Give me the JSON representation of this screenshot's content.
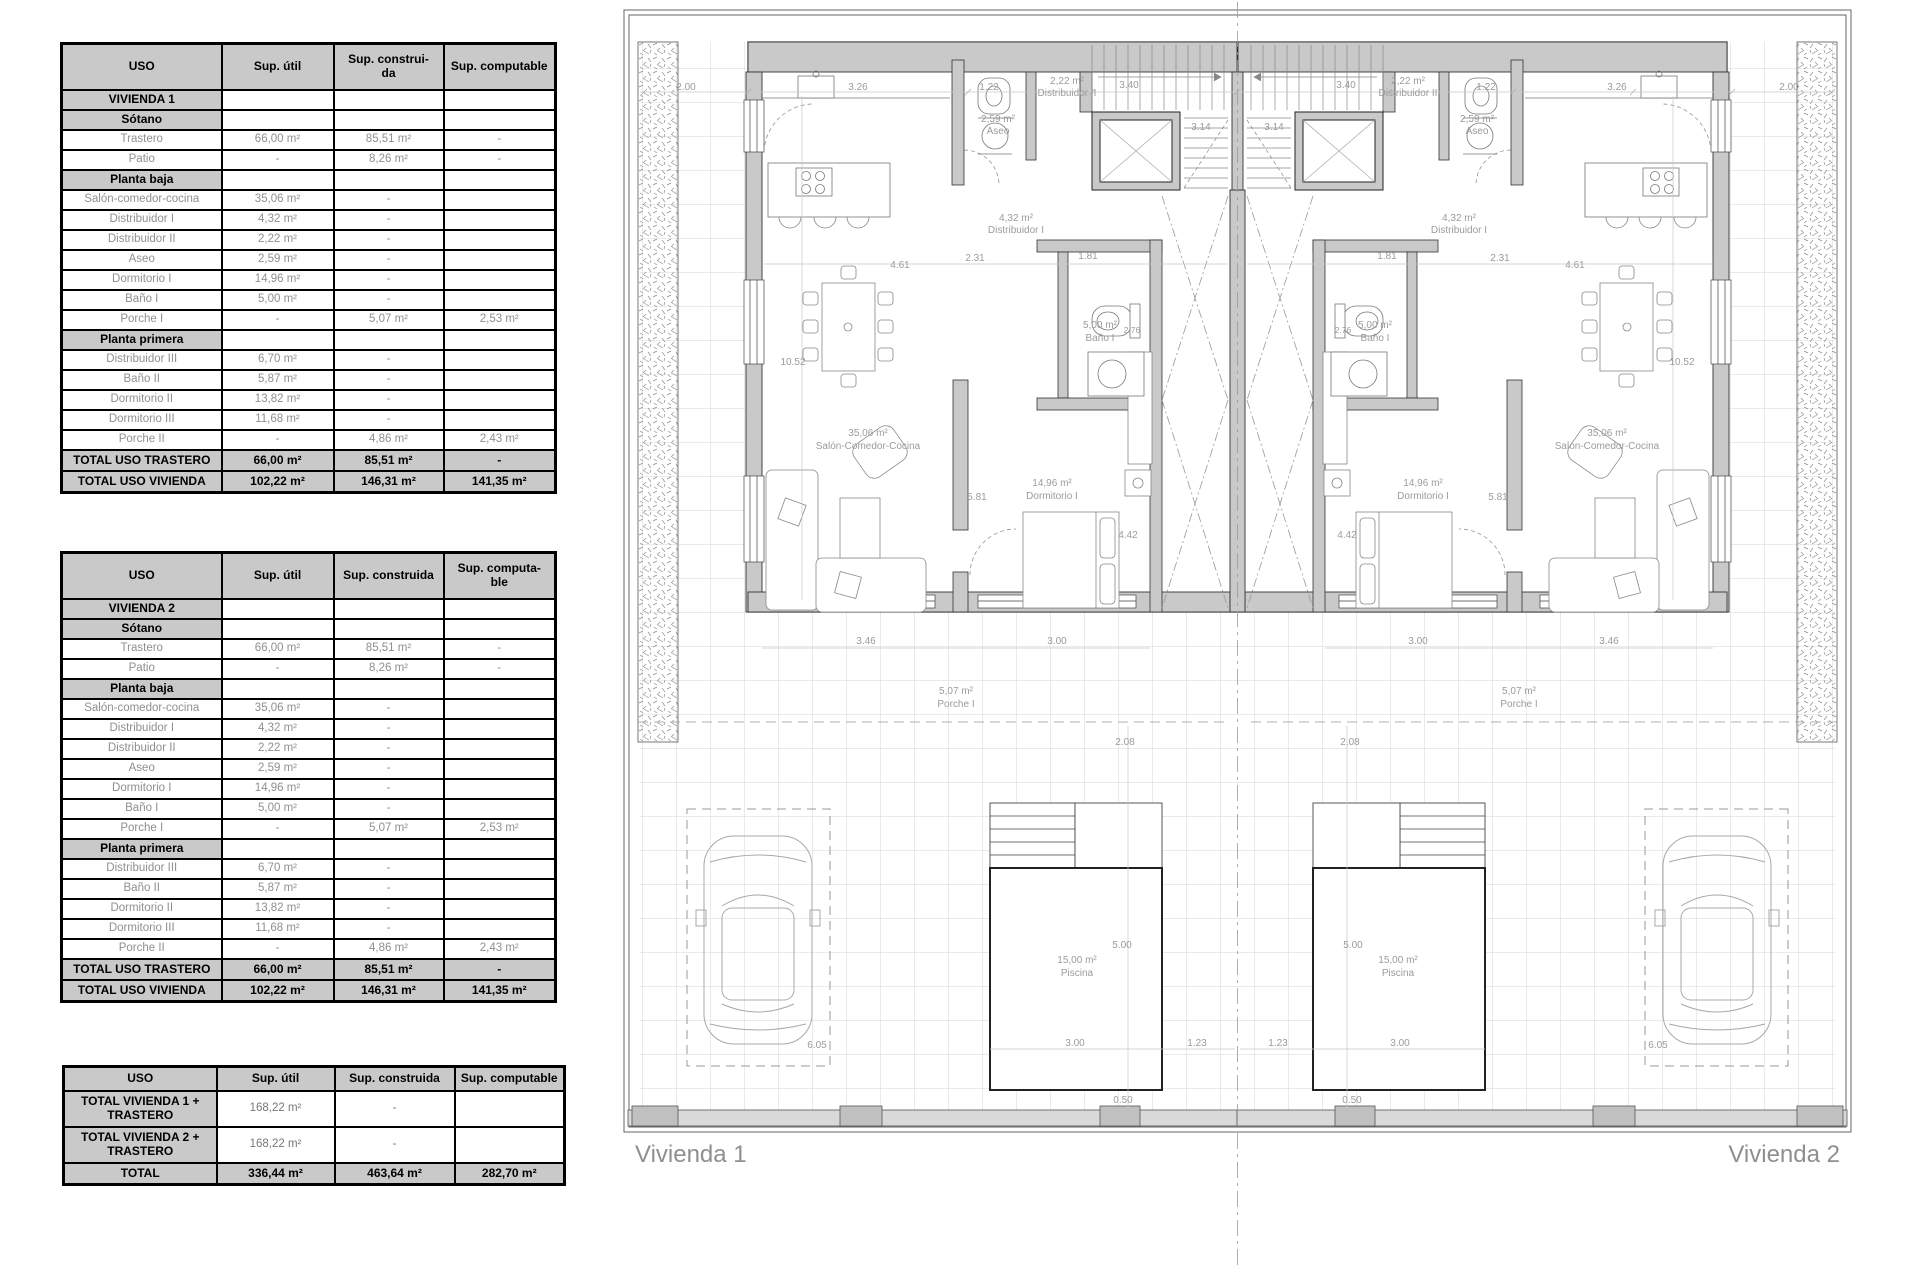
{
  "tables": [
    {
      "headers": [
        "USO",
        "Sup. útil",
        "Sup. construi-\nda",
        "Sup. computable"
      ],
      "rows": [
        {
          "t": "sec",
          "c": [
            "VIVIENDA 1",
            "",
            "",
            ""
          ]
        },
        {
          "t": "sec",
          "c": [
            "Sótano",
            "",
            "",
            ""
          ]
        },
        {
          "t": "data",
          "c": [
            "Trastero",
            "66,00 m²",
            "85,51 m²",
            "-"
          ]
        },
        {
          "t": "data",
          "c": [
            "Patio",
            "-",
            "8,26 m²",
            "-"
          ]
        },
        {
          "t": "sec",
          "c": [
            "Planta baja",
            "",
            "",
            ""
          ]
        },
        {
          "t": "data",
          "c": [
            "Salón-comedor-cocina",
            "35,06 m²",
            "-",
            ""
          ]
        },
        {
          "t": "data",
          "c": [
            "Distribuidor I",
            "4,32 m²",
            "-",
            ""
          ]
        },
        {
          "t": "data",
          "c": [
            "Distribuidor II",
            "2,22 m²",
            "-",
            ""
          ]
        },
        {
          "t": "data",
          "c": [
            "Aseo",
            "2,59 m²",
            "-",
            ""
          ]
        },
        {
          "t": "data",
          "c": [
            "Dormitorio I",
            "14,96 m²",
            "-",
            ""
          ]
        },
        {
          "t": "data",
          "c": [
            "Baño I",
            "5,00 m²",
            "-",
            ""
          ]
        },
        {
          "t": "data",
          "c": [
            "Porche I",
            "-",
            "5,07 m²",
            "2,53 m²"
          ]
        },
        {
          "t": "sec",
          "c": [
            "Planta primera",
            "",
            "",
            ""
          ]
        },
        {
          "t": "data",
          "c": [
            "Distribuidor III",
            "6,70 m²",
            "-",
            ""
          ]
        },
        {
          "t": "data",
          "c": [
            "Baño II",
            "5,87 m²",
            "-",
            ""
          ]
        },
        {
          "t": "data",
          "c": [
            "Dormitorio II",
            "13,82 m²",
            "-",
            ""
          ]
        },
        {
          "t": "data",
          "c": [
            "Dormitorio III",
            "11,68 m²",
            "-",
            ""
          ]
        },
        {
          "t": "data",
          "c": [
            "Porche II",
            "-",
            "4,86 m²",
            "2,43 m²"
          ]
        },
        {
          "t": "tot",
          "c": [
            "TOTAL USO TRASTERO",
            "66,00 m²",
            "85,51 m²",
            "-"
          ]
        },
        {
          "t": "tot",
          "c": [
            "TOTAL USO VIVIENDA",
            "102,22 m²",
            "146,31 m²",
            "141,35 m²"
          ]
        }
      ]
    },
    {
      "headers": [
        "USO",
        "Sup. útil",
        "Sup. construida",
        "Sup. computa-\nble"
      ],
      "rows": [
        {
          "t": "sec",
          "c": [
            "VIVIENDA 2",
            "",
            "",
            ""
          ]
        },
        {
          "t": "sec",
          "c": [
            "Sótano",
            "",
            "",
            ""
          ]
        },
        {
          "t": "data",
          "c": [
            "Trastero",
            "66,00 m²",
            "85,51 m²",
            "-"
          ]
        },
        {
          "t": "data",
          "c": [
            "Patio",
            "-",
            "8,26 m²",
            "-"
          ]
        },
        {
          "t": "sec",
          "c": [
            "Planta baja",
            "",
            "",
            ""
          ]
        },
        {
          "t": "data",
          "c": [
            "Salón-comedor-cocina",
            "35,06 m²",
            "-",
            ""
          ]
        },
        {
          "t": "data",
          "c": [
            "Distribuidor I",
            "4,32 m²",
            "-",
            ""
          ]
        },
        {
          "t": "data",
          "c": [
            "Distribuidor II",
            "2,22 m²",
            "-",
            ""
          ]
        },
        {
          "t": "data",
          "c": [
            "Aseo",
            "2,59 m²",
            "-",
            ""
          ]
        },
        {
          "t": "data",
          "c": [
            "Dormitorio I",
            "14,96 m²",
            "-",
            ""
          ]
        },
        {
          "t": "data",
          "c": [
            "Baño I",
            "5,00 m²",
            "-",
            ""
          ]
        },
        {
          "t": "data",
          "c": [
            "Porche I",
            "-",
            "5,07 m²",
            "2,53 m²"
          ]
        },
        {
          "t": "sec",
          "c": [
            "Planta primera",
            "",
            "",
            ""
          ]
        },
        {
          "t": "data",
          "c": [
            "Distribuidor III",
            "6,70 m²",
            "-",
            ""
          ]
        },
        {
          "t": "data",
          "c": [
            "Baño II",
            "5,87 m²",
            "-",
            ""
          ]
        },
        {
          "t": "data",
          "c": [
            "Dormitorio II",
            "13,82 m²",
            "-",
            ""
          ]
        },
        {
          "t": "data",
          "c": [
            "Dormitorio III",
            "11,68 m²",
            "-",
            ""
          ]
        },
        {
          "t": "data",
          "c": [
            "Porche II",
            "-",
            "4,86 m²",
            "2,43 m²"
          ]
        },
        {
          "t": "tot",
          "c": [
            "TOTAL USO TRASTERO",
            "66,00 m²",
            "85,51 m²",
            "-"
          ]
        },
        {
          "t": "tot",
          "c": [
            "TOTAL USO VIVIENDA",
            "102,22 m²",
            "146,31 m²",
            "141,35 m²"
          ]
        }
      ]
    },
    {
      "headers": [
        "USO",
        "Sup. útil",
        "Sup. construida",
        "Sup. computable"
      ],
      "rows": [
        {
          "t": "tot2",
          "c": [
            "TOTAL VIVIENDA 1 + TRASTERO",
            "168,22 m²",
            "-",
            ""
          ]
        },
        {
          "t": "tot2",
          "c": [
            "TOTAL VIVIENDA 2 + TRASTERO",
            "168,22 m²",
            "-",
            ""
          ]
        },
        {
          "t": "tot",
          "c": [
            "TOTAL",
            "336,44 m²",
            "463,64  m²",
            "282,70  m²"
          ]
        }
      ]
    }
  ],
  "plan": {
    "labels": {
      "d200": "2.00",
      "d326": "3.26",
      "d122": "1.22",
      "d340": "3.40",
      "d314": "3.14",
      "d181": "1.81",
      "d231": "2.31",
      "d461": "4.61",
      "d276": "2.76",
      "d1052": "10.52",
      "d581": "5.81",
      "d442": "4.42",
      "d346": "3.46",
      "d300": "3.00",
      "d208": "2.08",
      "d500": "5.00",
      "d123": "1.23",
      "d050": "0.50",
      "d605": "6.05",
      "aseo_area": "2,59 m²",
      "aseo_name": "Aseo",
      "dist2_area": "2,22 m²",
      "dist2_name": "Distribuidor II",
      "dist1_area": "4,32 m²",
      "dist1_name": "Distribuidor I",
      "salon_area": "35,06 m²",
      "salon_name": "Salón-Comedor-Cocina",
      "dorm1_area": "14,96 m²",
      "dorm1_name": "Dormitorio I",
      "bano1_area": "5,00 m²",
      "bano1_name": "Baño I",
      "porche_area": "5,07 m²",
      "porche_name": "Porche I",
      "piscina_area": "15,00 m²",
      "piscina_name": "Piscina"
    },
    "footer_left": "Vivienda 1",
    "footer_right": "Vivienda 2"
  }
}
